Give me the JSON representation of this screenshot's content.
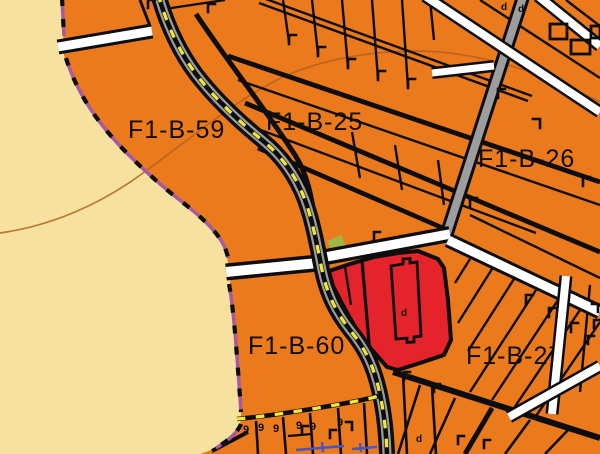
{
  "map": {
    "zones": [
      {
        "label": "F1-B-59"
      },
      {
        "label": "F1-B-25"
      },
      {
        "label": "F1-B-26"
      },
      {
        "label": "F1-B-60"
      },
      {
        "label": "F1-B-27"
      }
    ],
    "glyphs": {
      "nine": "9",
      "d": "d"
    },
    "colors": {
      "zone_orange": "#EB7A1C",
      "beach_yellow": "#F6E29E",
      "parcel_red": "#E5232B",
      "boundary_purple": "#A659A3",
      "road_gray": "#9D9D9D",
      "road_white": "#FFFFFF",
      "dash_yellow": "#EFE83B",
      "line_black": "#0D0D0D",
      "contour_brown": "#B5601F",
      "green_patch": "#9FB544",
      "utility_blue": "#4A55C0"
    }
  }
}
